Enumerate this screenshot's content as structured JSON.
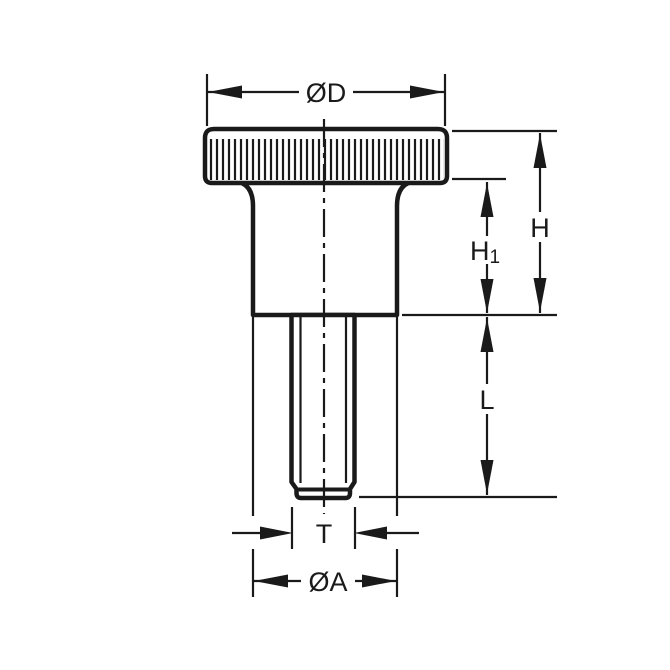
{
  "drawing": {
    "background_color": "#ffffff",
    "line_color": "#1a1a1a",
    "dimensions": {
      "od": {
        "label": "ØD"
      },
      "h": {
        "label": "H"
      },
      "h1": {
        "base": "H",
        "sub": "1"
      },
      "l": {
        "label": "L"
      },
      "t": {
        "label": "T"
      },
      "oa": {
        "label": "ØA"
      }
    }
  }
}
